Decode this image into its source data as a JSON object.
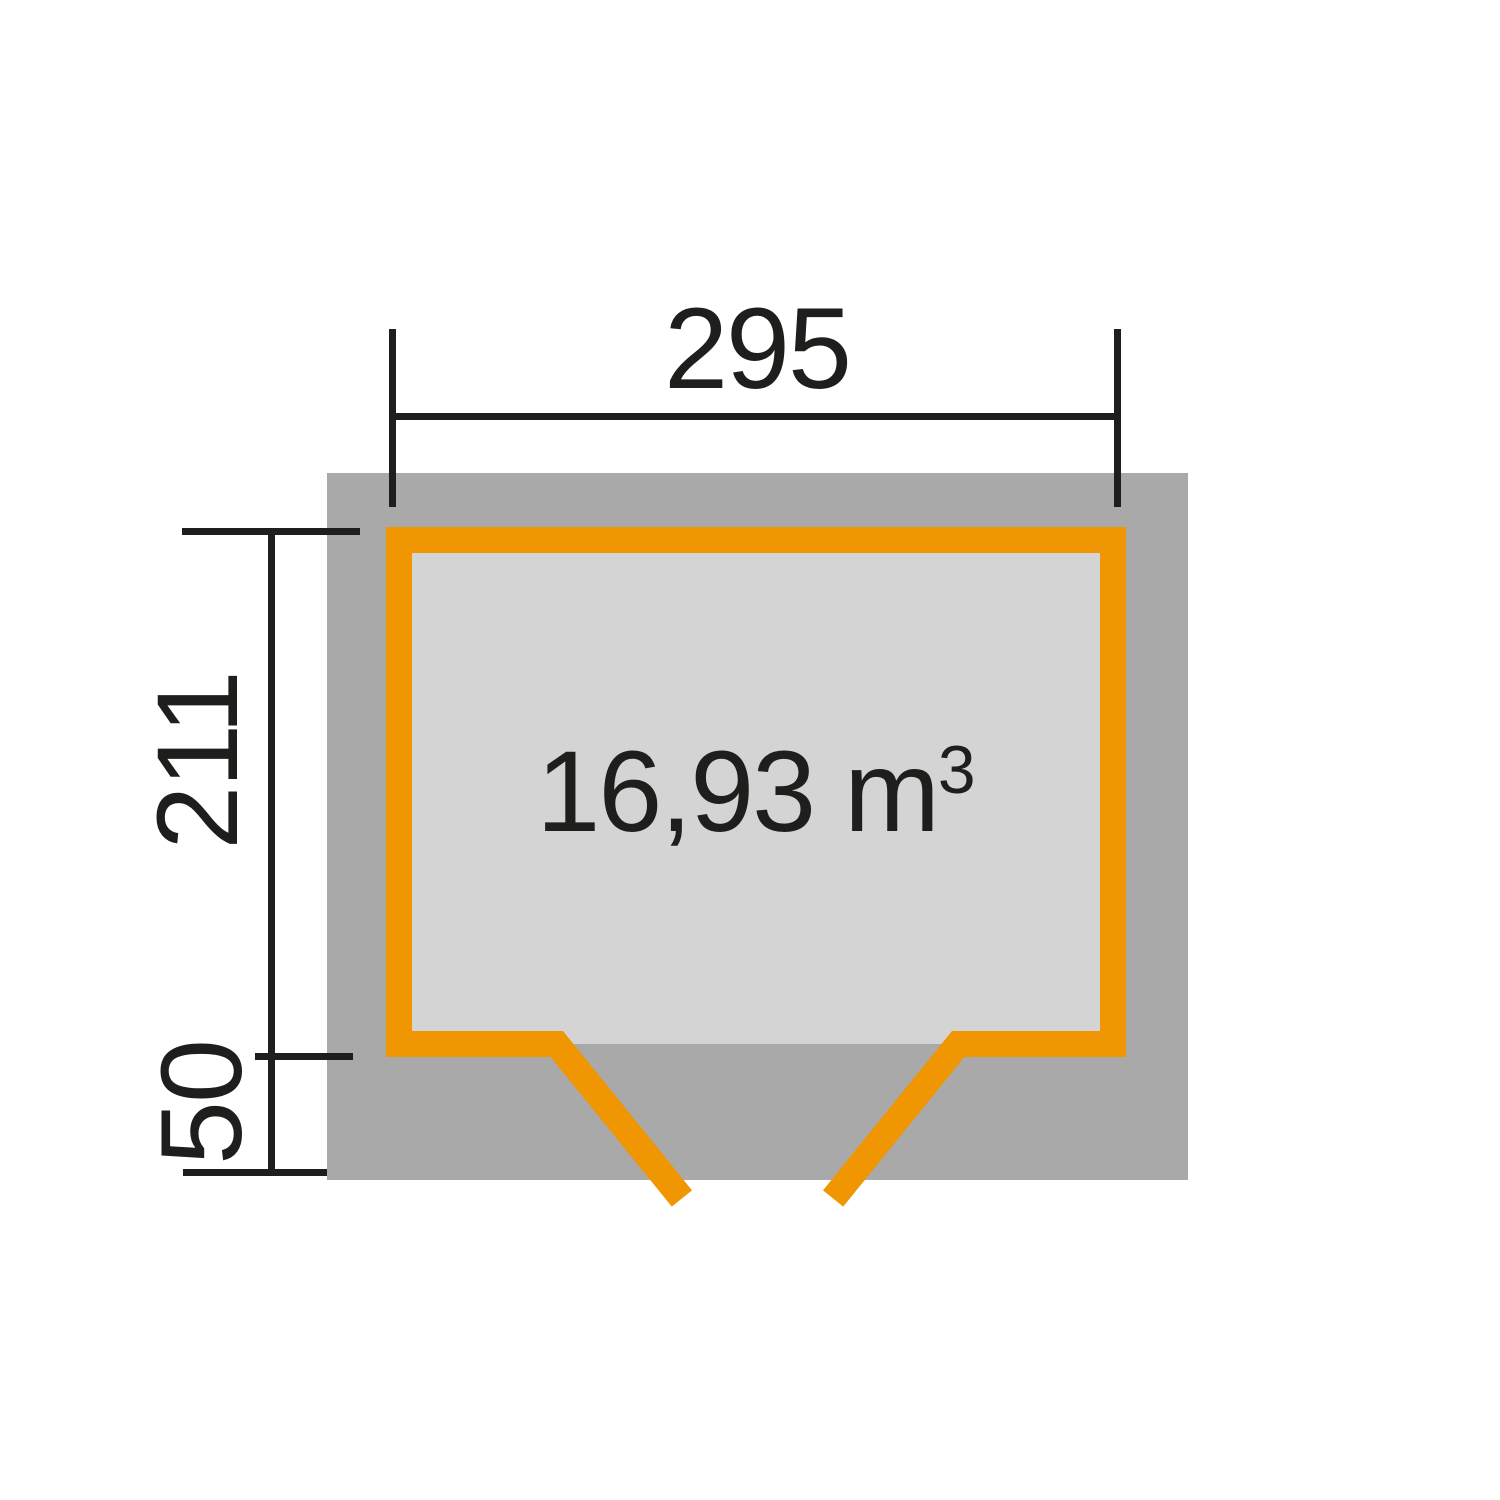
{
  "plan": {
    "width_label": "295",
    "depth_label": "211",
    "overhang_label": "50",
    "volume_base": "16,93 m",
    "volume_exponent": "3",
    "colors": {
      "accent_orange": "#EF9602",
      "overhang_gray": "#A9A9A9",
      "interior_gray": "#D4D4D4",
      "line_color": "#1E1E1C",
      "background": "#FFFFFF"
    }
  }
}
